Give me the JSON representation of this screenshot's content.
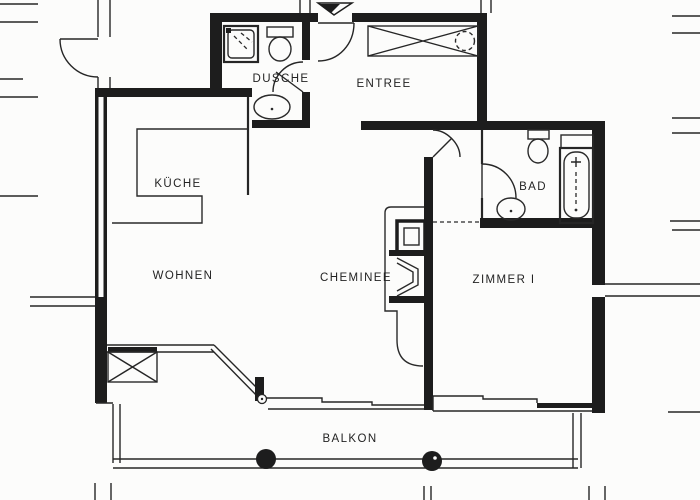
{
  "floorplan": {
    "rooms": [
      {
        "id": "kueche",
        "label": "KÜCHE"
      },
      {
        "id": "dusche",
        "label": "DUSCHE"
      },
      {
        "id": "entree",
        "label": "ENTREE"
      },
      {
        "id": "bad",
        "label": "BAD"
      },
      {
        "id": "wohnen",
        "label": "WOHNEN"
      },
      {
        "id": "cheminee",
        "label": "CHEMINEE"
      },
      {
        "id": "zimmer_i",
        "label": "ZIMMER I"
      },
      {
        "id": "balkon",
        "label": "BALKON"
      }
    ],
    "fixtures": [
      "shower",
      "toilet-dusche",
      "washbasin-dusche",
      "wardrobe",
      "ceiling-light",
      "toilet-bad",
      "washbasin-bad",
      "bathtub",
      "fireplace",
      "kitchen-counter",
      "balcony-columns",
      "entrance-marker"
    ],
    "colors": {
      "ink": "#1d1d1d",
      "paper": "#fcfcfb"
    }
  }
}
